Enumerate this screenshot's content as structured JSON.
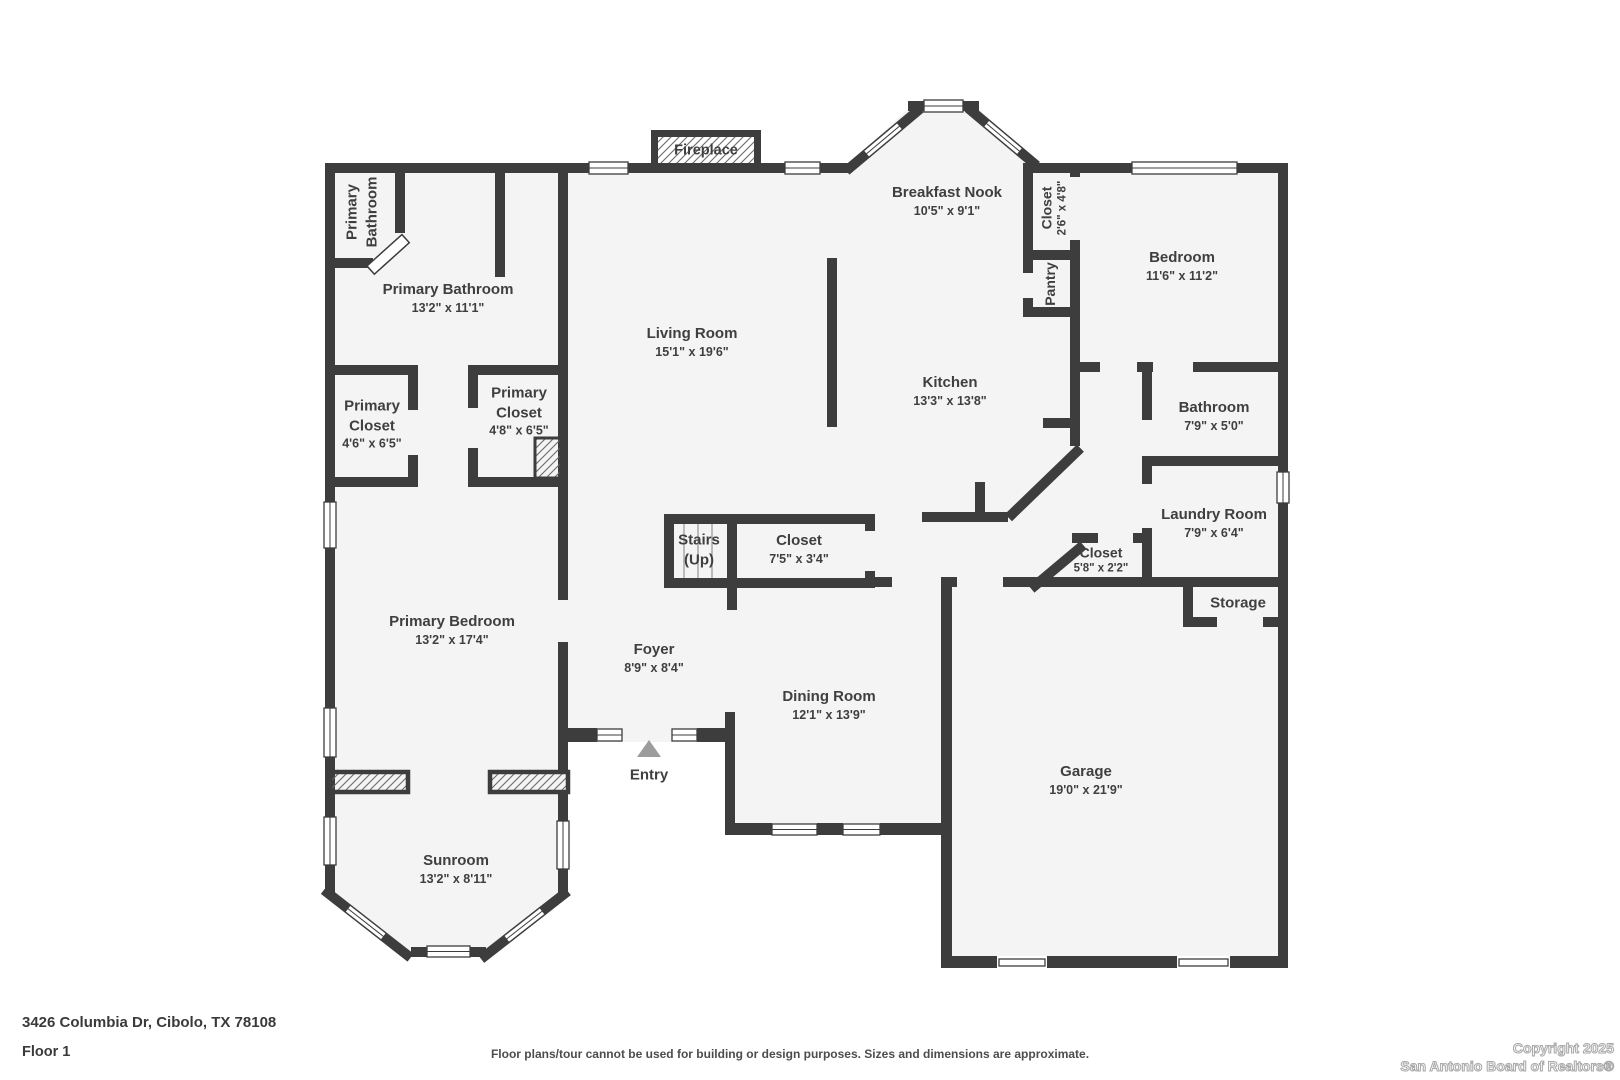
{
  "colors": {
    "wall": "#3d3d3d",
    "floor": "#f4f4f4",
    "label_text": "#3f3f3f",
    "entry_arrow": "#9c9c9c",
    "stair_line": "#a8a8a8"
  },
  "rooms": [
    {
      "name": "Primary Bathroom"
    },
    {
      "name": "Primary Bathroom",
      "dims": "13'2\" x 11'1\""
    },
    {
      "name": "Primary Closet",
      "dims": "4'6\" x 6'5\""
    },
    {
      "name": "Primary Closet",
      "dims": "4'8\" x 6'5\""
    },
    {
      "name": "Primary Bedroom",
      "dims": "13'2\" x 17'4\""
    },
    {
      "name": "Sunroom",
      "dims": "13'2\" x 8'11\""
    },
    {
      "name": "Living Room",
      "dims": "15'1\" x 19'6\""
    },
    {
      "name": "Breakfast Nook",
      "dims": "10'5\" x 9'1\""
    },
    {
      "name": "Closet",
      "dims": "2'6\" x 4'8\""
    },
    {
      "name": "Pantry"
    },
    {
      "name": "Bedroom",
      "dims": "11'6\" x 11'2\""
    },
    {
      "name": "Kitchen",
      "dims": "13'3\" x 13'8\""
    },
    {
      "name": "Bathroom",
      "dims": "7'9\" x 5'0\""
    },
    {
      "name": "Laundry Room",
      "dims": "7'9\" x 6'4\""
    },
    {
      "name": "Closet",
      "dims": "5'8\" x 2'2\""
    },
    {
      "name": "Storage"
    },
    {
      "name": "Stairs (Up)"
    },
    {
      "name": "Closet",
      "dims": "7'5\" x 3'4\""
    },
    {
      "name": "Foyer",
      "dims": "8'9\" x 8'4\""
    },
    {
      "name": "Dining Room",
      "dims": "12'1\" x 13'9\""
    },
    {
      "name": "Garage",
      "dims": "19'0\" x 21'9\""
    },
    {
      "name": "Entry"
    },
    {
      "name": "Fireplace"
    }
  ],
  "footer": {
    "address": "3426 Columbia Dr, Cibolo, TX 78108",
    "floor": "Floor 1",
    "disclaimer": "Floor plans/tour cannot be used for building or design purposes. Sizes and dimensions are approximate.",
    "copyright_line1": "Copyright 2025",
    "copyright_line2": "San Antonio Board of Realtors®"
  }
}
